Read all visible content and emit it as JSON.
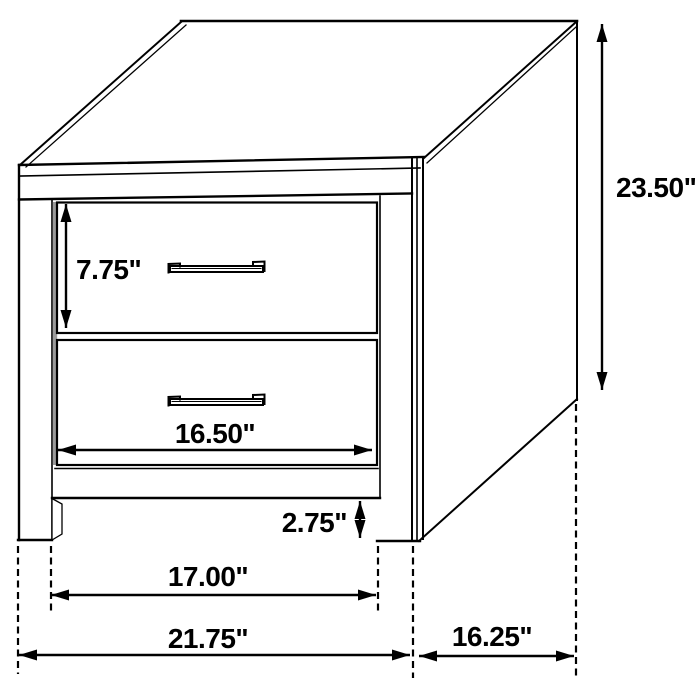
{
  "diagram": {
    "type": "furniture-dimension-diagram",
    "item": "2-drawer nightstand",
    "unit": "inches",
    "colors": {
      "line": "#000000",
      "background": "#ffffff",
      "reveal_shadow": "#9a9a9a"
    },
    "dimensions": {
      "overall_height": {
        "label": "23.50\"",
        "value": 23.5
      },
      "overall_width": {
        "label": "21.75\"",
        "value": 21.75
      },
      "overall_depth": {
        "label": "16.25\"",
        "value": 16.25
      },
      "drawer_height": {
        "label": "7.75\"",
        "value": 7.75
      },
      "drawer_width": {
        "label": "16.50\"",
        "value": 16.5
      },
      "leg_opening_width": {
        "label": "17.00\"",
        "value": 17.0
      },
      "base_clearance": {
        "label": "2.75\"",
        "value": 2.75
      }
    }
  }
}
